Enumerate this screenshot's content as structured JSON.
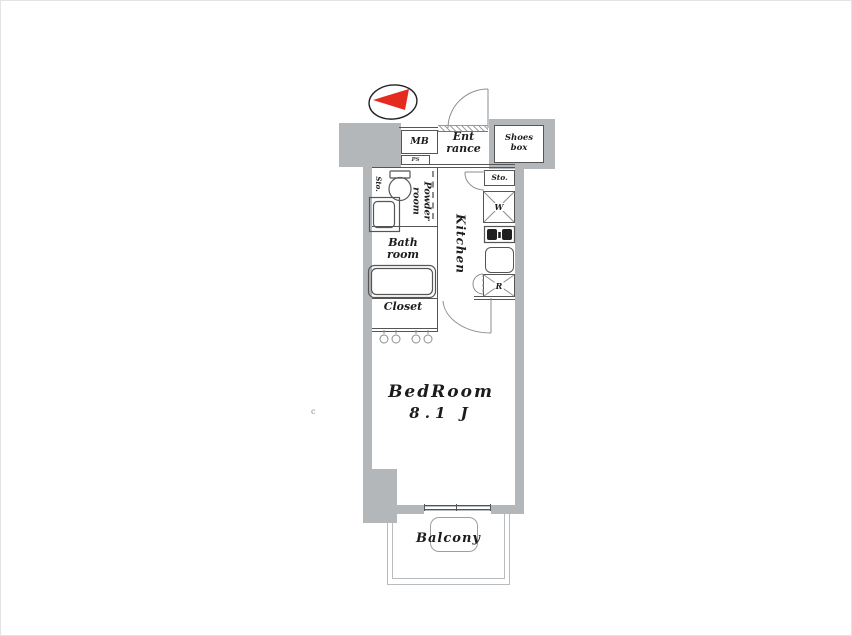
{
  "colors": {
    "wall": "#b3b7ba",
    "line": "#555555",
    "balcony_line": "#b9bcbe",
    "compass_red": "#e52a1e",
    "text": "#1c1c1c"
  },
  "labels": {
    "mb": "MB",
    "ps": "PS",
    "entrance1": "Ent",
    "entrance2": "rance",
    "shoes1": "Shoes",
    "shoes2": "box",
    "sto_entry": "Sto.",
    "sto_shelf": "Sto.",
    "powder1": "Powder",
    "powder2": "room",
    "bath1": "Bath",
    "bath2": "room",
    "kitchen": "Kitchen",
    "closet": "Closet",
    "washer": "W",
    "fridge": "R",
    "bedroom": "BedRoom",
    "bedroom_size": "8.1 J",
    "balcony": "Balcony",
    "stray": "c"
  }
}
